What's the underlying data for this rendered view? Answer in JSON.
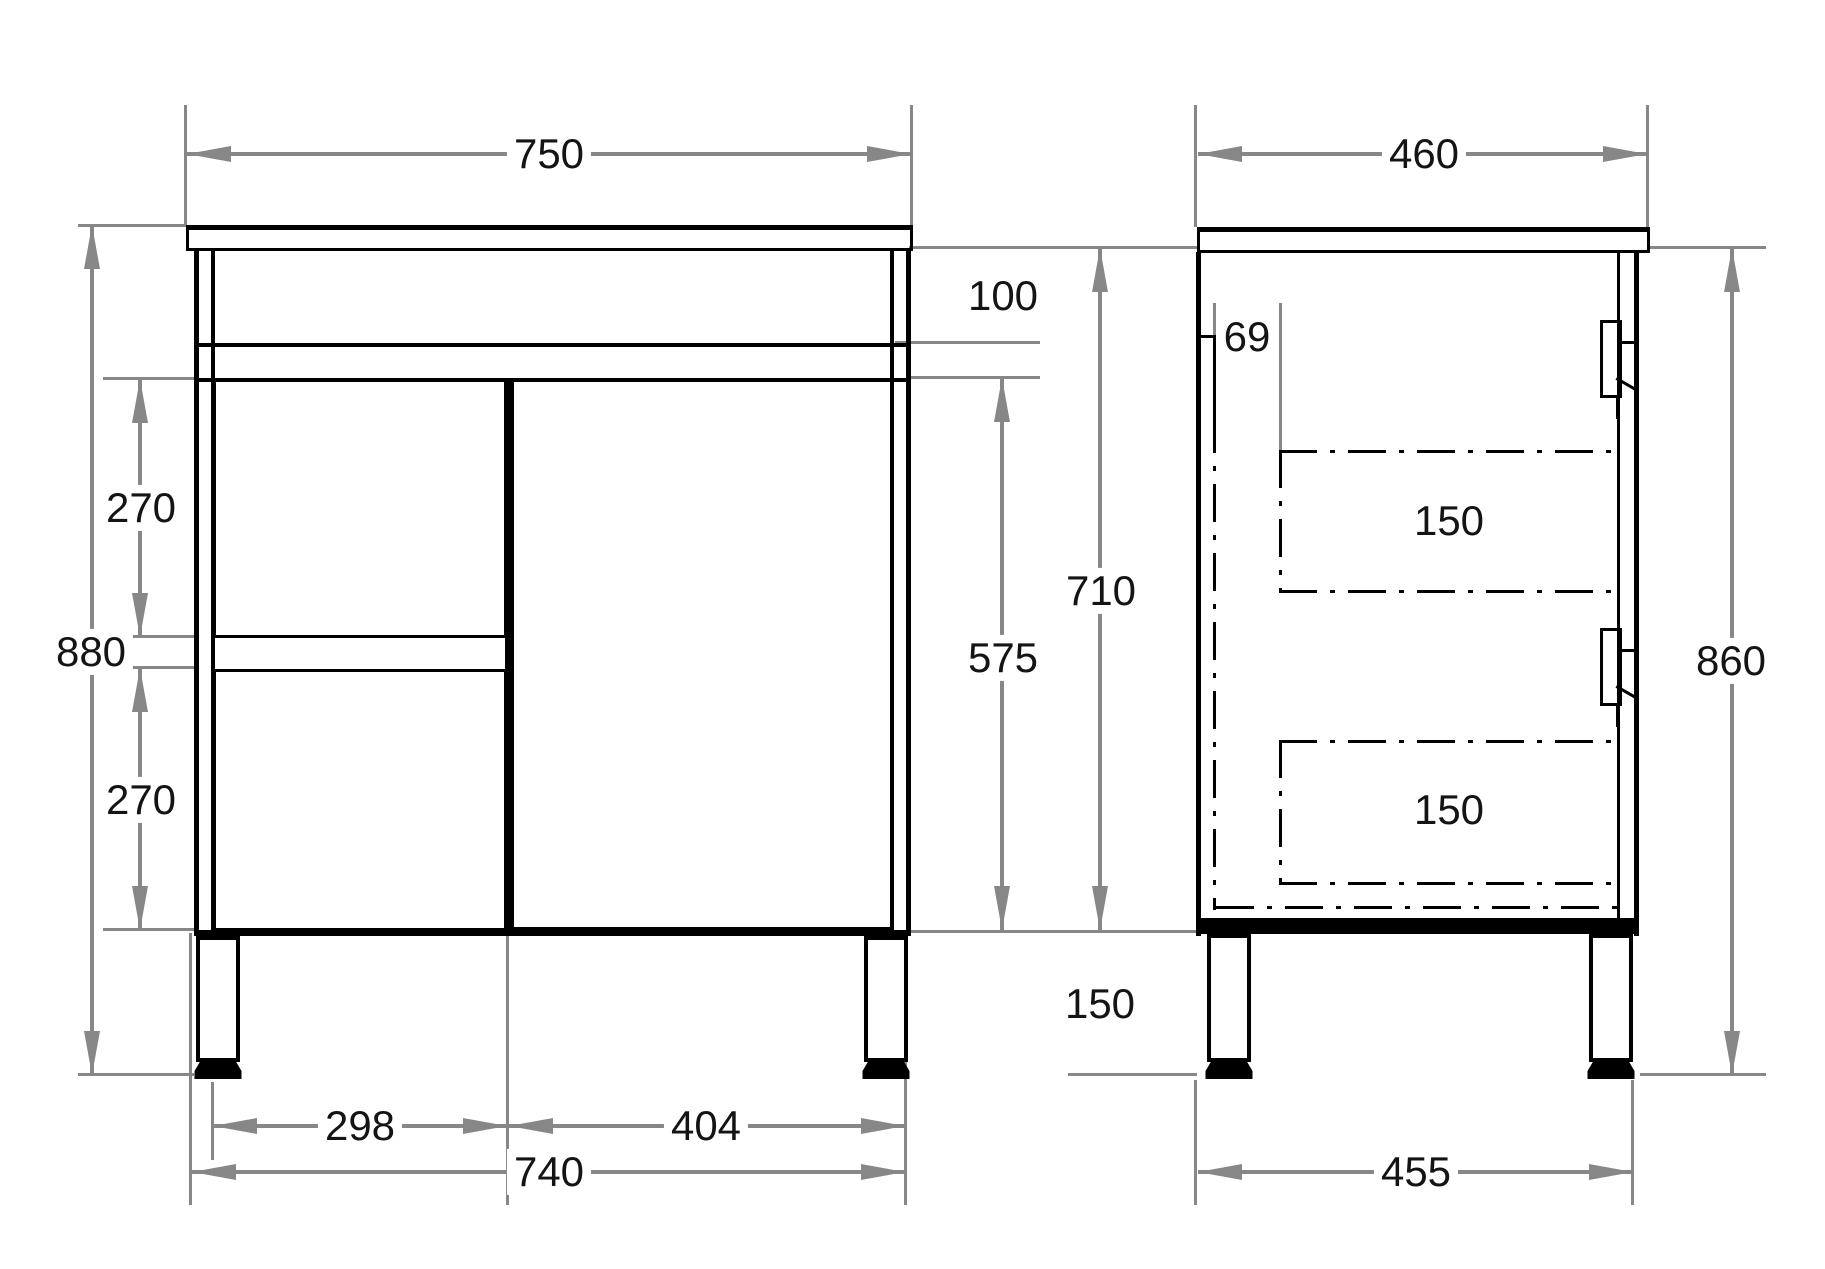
{
  "drawing": {
    "type": "technical-drawing",
    "subject": "bathroom vanity cabinet with drawers, door and legs",
    "units": "mm",
    "front_view": {
      "countertop_width": "750",
      "top_rail_height": "100",
      "drawer1_height": "270",
      "overall_height": "880",
      "drawer2_height": "270",
      "door_height": "575",
      "drawer_bank_width": "298",
      "door_width": "404",
      "carcass_width": "740"
    },
    "side_view": {
      "countertop_depth": "460",
      "back_clearance": "69",
      "carcass_height": "710",
      "drawer1_depth": "150",
      "drawer2_depth": "150",
      "height_excluding_top": "860",
      "leg_height": "150",
      "leg_span_depth": "455"
    },
    "colors": {
      "structure_line": "#000000",
      "dimension_line": "#878787",
      "text": "#141414",
      "background": "#ffffff"
    }
  }
}
